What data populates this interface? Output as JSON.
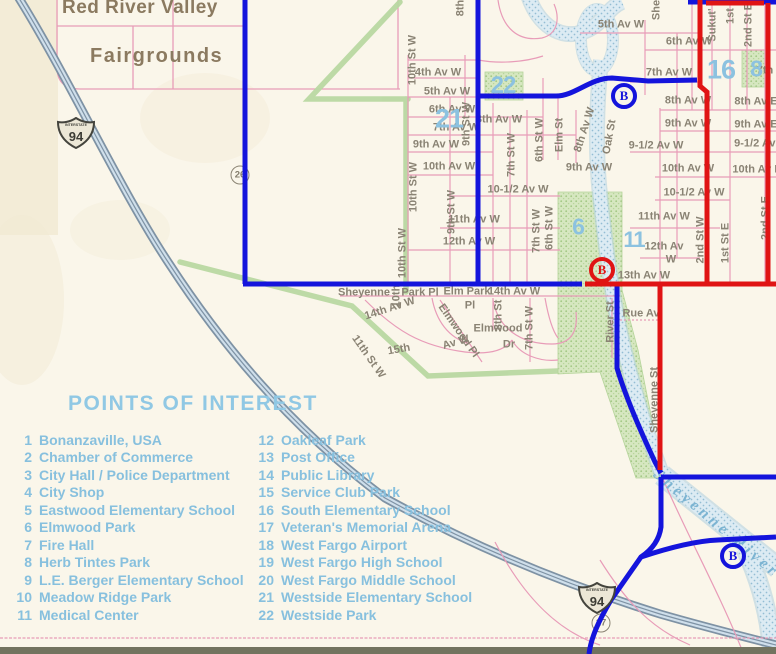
{
  "colors": {
    "paper": "#faf6ea",
    "blue": "#1414dc",
    "red": "#e01414",
    "pink": "#e89cb8",
    "green": "#b9d8a2",
    "parkFill": "#d6e7c0",
    "parkDot": "#a3c785",
    "river": "#dcebf3",
    "riverDot": "#93bdd4",
    "riverEdge": "#aecfe0",
    "highwayCase": "#7e92a4",
    "highwayFill": "#cfdfeb",
    "label": "#8a8374",
    "poi": "#87c0de",
    "heading": "#90c8e4",
    "brown": "#8b7a60",
    "numberBlue": "#8cc2e0"
  },
  "map": {
    "area_labels": {
      "red_river_valley": "Red River Valley",
      "fairgrounds": "Fairgrounds"
    },
    "river_label": "Sheyenne River",
    "street_labels": [
      {
        "t": "4th Av W",
        "x": 438,
        "y": 73
      },
      {
        "t": "5th Av W",
        "x": 447,
        "y": 92
      },
      {
        "t": "6th Av W",
        "x": 452,
        "y": 110
      },
      {
        "t": "7th Av W",
        "x": 456,
        "y": 128
      },
      {
        "t": "8th Av W",
        "x": 499,
        "y": 120
      },
      {
        "t": "9th Av W",
        "x": 436,
        "y": 145
      },
      {
        "t": "10th Av W",
        "x": 449,
        "y": 167
      },
      {
        "t": "10-1/2 Av W",
        "x": 518,
        "y": 190
      },
      {
        "t": "11th Av W",
        "x": 474,
        "y": 220
      },
      {
        "t": "12th Av W",
        "x": 469,
        "y": 242
      },
      {
        "t": "9th Av W",
        "x": 589,
        "y": 168
      },
      {
        "t": "5th Av W",
        "x": 621,
        "y": 25
      },
      {
        "t": "6th Av W",
        "x": 689,
        "y": 42
      },
      {
        "t": "7th Av W",
        "x": 669,
        "y": 73
      },
      {
        "t": "8th Av W",
        "x": 688,
        "y": 101
      },
      {
        "t": "8th Av E",
        "x": 756,
        "y": 102
      },
      {
        "t": "9th Av W",
        "x": 688,
        "y": 124
      },
      {
        "t": "9th Av E",
        "x": 756,
        "y": 125
      },
      {
        "t": "9-1/2 Av W",
        "x": 656,
        "y": 146
      },
      {
        "t": "9-1/2 Av E",
        "x": 760,
        "y": 144
      },
      {
        "t": "10th Av W",
        "x": 688,
        "y": 169
      },
      {
        "t": "10th Av E",
        "x": 757,
        "y": 170
      },
      {
        "t": "10-1/2 Av W",
        "x": 694,
        "y": 193
      },
      {
        "t": "11th Av W",
        "x": 664,
        "y": 217
      },
      {
        "t": "12th Av",
        "x": 664,
        "y": 247
      },
      {
        "t": "W",
        "x": 671,
        "y": 260
      },
      {
        "t": "13th Av W",
        "x": 644,
        "y": 276
      },
      {
        "t": "14th Av W",
        "x": 514,
        "y": 292
      },
      {
        "t": "Rue Av",
        "x": 641,
        "y": 314
      },
      {
        "t": "Sheyenne",
        "x": 364,
        "y": 293
      },
      {
        "t": "Park Pl",
        "x": 420,
        "y": 293
      },
      {
        "t": "Elm Park",
        "x": 467,
        "y": 292
      },
      {
        "t": "Pl",
        "x": 470,
        "y": 306
      },
      {
        "t": "Elmwood",
        "x": 498,
        "y": 329
      },
      {
        "t": "Dr",
        "x": 509,
        "y": 345
      },
      {
        "t": "7th",
        "x": 765,
        "y": 71
      },
      {
        "t": "10th St W",
        "x": 413,
        "y": 60,
        "r": -90
      },
      {
        "t": "10th St W",
        "x": 414,
        "y": 187,
        "r": -90
      },
      {
        "t": "10th St W",
        "x": 403,
        "y": 253,
        "r": -90
      },
      {
        "t": "9th St W",
        "x": 467,
        "y": 124,
        "r": -90
      },
      {
        "t": "9th St W",
        "x": 452,
        "y": 212,
        "r": -90
      },
      {
        "t": "8th",
        "x": 461,
        "y": 8,
        "r": -90
      },
      {
        "t": "7th St W",
        "x": 512,
        "y": 155,
        "r": -90
      },
      {
        "t": "6th St W",
        "x": 540,
        "y": 140,
        "r": -90
      },
      {
        "t": "Elm St",
        "x": 560,
        "y": 135,
        "r": -90
      },
      {
        "t": "8th Av W",
        "x": 585,
        "y": 130,
        "r": -72
      },
      {
        "t": "Oak St",
        "x": 610,
        "y": 137,
        "r": -80
      },
      {
        "t": "7th St W",
        "x": 537,
        "y": 231,
        "r": -90
      },
      {
        "t": "6th St W",
        "x": 550,
        "y": 228,
        "r": -90
      },
      {
        "t": "2nd St W",
        "x": 701,
        "y": 240,
        "r": -90
      },
      {
        "t": "1st St E",
        "x": 726,
        "y": 243,
        "r": -90
      },
      {
        "t": "2nd St E",
        "x": 766,
        "y": 218,
        "r": -90
      },
      {
        "t": "She",
        "x": 657,
        "y": 10,
        "r": -90
      },
      {
        "t": "Sukut'",
        "x": 713,
        "y": 25,
        "r": -90
      },
      {
        "t": "1st",
        "x": 731,
        "y": 16,
        "r": -90
      },
      {
        "t": "2nd St E",
        "x": 749,
        "y": 25,
        "r": -90
      },
      {
        "t": "River St",
        "x": 611,
        "y": 322,
        "r": -90
      },
      {
        "t": "Sheyenne St",
        "x": 655,
        "y": 400,
        "r": -90
      },
      {
        "t": "10th",
        "x": 397,
        "y": 296,
        "r": -90
      },
      {
        "t": "8th St",
        "x": 499,
        "y": 315,
        "r": -90
      },
      {
        "t": "7th St W",
        "x": 530,
        "y": 328,
        "r": -90
      },
      {
        "t": "11th St W",
        "x": 368,
        "y": 357,
        "r": 55
      },
      {
        "t": "14th Av W",
        "x": 390,
        "y": 309,
        "r": -18
      },
      {
        "t": "15th",
        "x": 399,
        "y": 350,
        "r": -10
      },
      {
        "t": "Av W",
        "x": 456,
        "y": 343,
        "r": -16
      },
      {
        "t": "Elmwood Pl",
        "x": 458,
        "y": 331,
        "r": 55
      }
    ],
    "park_numbers": [
      {
        "n": "21",
        "x": 449,
        "y": 119,
        "s": 27
      },
      {
        "n": "22",
        "x": 503,
        "y": 86,
        "s": 24
      },
      {
        "n": "16",
        "x": 721,
        "y": 70,
        "s": 27
      },
      {
        "n": "8",
        "x": 756,
        "y": 69,
        "s": 23
      },
      {
        "n": "6",
        "x": 578,
        "y": 227,
        "s": 23
      },
      {
        "n": "11",
        "x": 634,
        "y": 240,
        "s": 22
      }
    ],
    "markers": {
      "interstate_shields": [
        {
          "label": "94",
          "top_text": "INTERSTATE",
          "x": 57,
          "y": 117
        },
        {
          "label": "94",
          "top_text": "INTERSTATE",
          "x": 578,
          "y": 582
        }
      ],
      "b_markers": [
        {
          "label": "B",
          "color": "blue",
          "x": 624,
          "y": 96
        },
        {
          "label": "B",
          "color": "red",
          "x": 602,
          "y": 270
        },
        {
          "label": "B",
          "color": "blue",
          "x": 733,
          "y": 556
        }
      ],
      "circled_roads": [
        {
          "label": "26",
          "x": 240,
          "y": 175
        },
        {
          "label": "17",
          "x": 601,
          "y": 623
        }
      ]
    }
  },
  "poi": {
    "title": "POINTS OF INTEREST",
    "column1": [
      {
        "n": "1",
        "name": "Bonanzaville, USA"
      },
      {
        "n": "2",
        "name": "Chamber of Commerce"
      },
      {
        "n": "3",
        "name": "City Hall / Police Department"
      },
      {
        "n": "4",
        "name": "City Shop"
      },
      {
        "n": "5",
        "name": "Eastwood Elementary School"
      },
      {
        "n": "6",
        "name": "Elmwood Park"
      },
      {
        "n": "7",
        "name": "Fire Hall"
      },
      {
        "n": "8",
        "name": "Herb Tintes Park"
      },
      {
        "n": "9",
        "name": "L.E. Berger Elementary School"
      },
      {
        "n": "10",
        "name": "Meadow Ridge Park"
      },
      {
        "n": "11",
        "name": "Medical Center"
      }
    ],
    "column2": [
      {
        "n": "12",
        "name": "Oakleaf Park"
      },
      {
        "n": "13",
        "name": "Post Office"
      },
      {
        "n": "14",
        "name": "Public Library"
      },
      {
        "n": "15",
        "name": "Service Club Park"
      },
      {
        "n": "16",
        "name": "South Elementary School"
      },
      {
        "n": "17",
        "name": "Veteran's Memorial Arena"
      },
      {
        "n": "18",
        "name": "West Fargo Airport"
      },
      {
        "n": "19",
        "name": "West Fargo High School"
      },
      {
        "n": "20",
        "name": "West Fargo Middle School"
      },
      {
        "n": "21",
        "name": "Westside Elementary School"
      },
      {
        "n": "22",
        "name": "Westside Park"
      }
    ]
  }
}
